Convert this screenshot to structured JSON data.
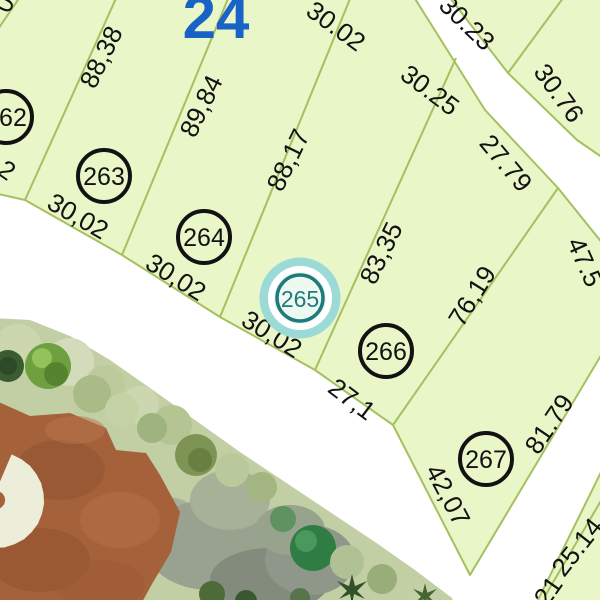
{
  "map": {
    "block_number": "24",
    "selected_lot": "265",
    "lots": [
      {
        "number": "262"
      },
      {
        "number": "263"
      },
      {
        "number": "264"
      },
      {
        "number": "265"
      },
      {
        "number": "266"
      },
      {
        "number": "267"
      }
    ],
    "dimensions": [
      {
        "side": "lot-262-frontage-partial",
        "text": "2"
      },
      {
        "side": "lot-263-frontage",
        "text": "30,02"
      },
      {
        "side": "lot-264-frontage",
        "text": "30,02"
      },
      {
        "side": "lot-265-frontage",
        "text": "30,02"
      },
      {
        "side": "lot-266-frontage",
        "text": "27,1"
      },
      {
        "side": "boundary-262-263",
        "text": "88,38"
      },
      {
        "side": "boundary-263-264",
        "text": "89,84"
      },
      {
        "side": "boundary-264-265",
        "text": "88,17"
      },
      {
        "side": "boundary-265-266",
        "text": "83,35"
      },
      {
        "side": "boundary-266-267",
        "text": "76,19"
      },
      {
        "side": "lot-267-southwest",
        "text": "42,07"
      },
      {
        "side": "lot-267-road",
        "text": "81.79"
      },
      {
        "side": "lot-267-northeast-partial",
        "text": "47.5"
      },
      {
        "side": "lot-264-rear",
        "text": "30.02"
      },
      {
        "side": "lot-265-rear",
        "text": "30.25"
      },
      {
        "side": "lot-266-rear",
        "text": "27.79"
      },
      {
        "side": "across-road-lot-a",
        "text": "30.23"
      },
      {
        "side": "across-road-lot-b",
        "text": "30.76"
      },
      {
        "side": "southeast-lot",
        "text": "25.14"
      },
      {
        "side": "southeast-lot-partial",
        "text": "21"
      },
      {
        "side": "top-left-partial",
        "text": "0"
      }
    ]
  },
  "colors": {
    "parcel_fill": "#e8f6c8",
    "parcel_border": "#a6c05f",
    "dimension_text": "#121212",
    "lot_circle": "#121212",
    "selected_ring": "#1d7b7c",
    "selected_halo": "#9cdad7",
    "block_number": "#1a63c6",
    "road": "#ffffff",
    "terrain_dirt": "#a5613a",
    "starburst": "#edeeda"
  }
}
